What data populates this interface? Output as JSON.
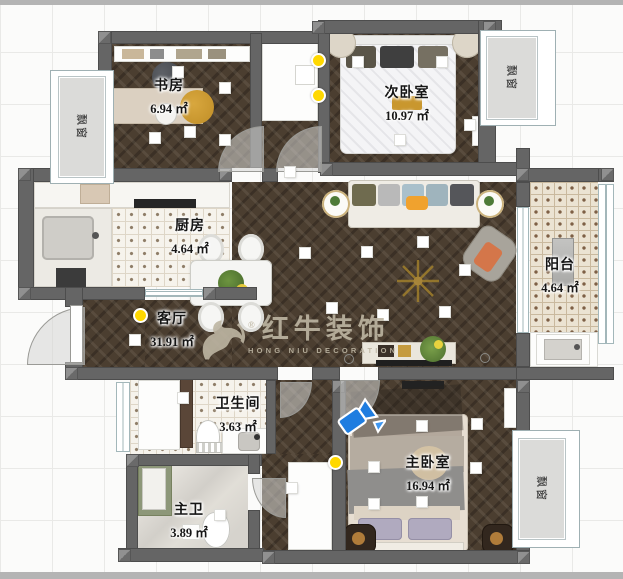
{
  "rooms": [
    {
      "name": "书房",
      "area": "6.94 ㎡"
    },
    {
      "name": "次卧室",
      "area": "10.97 ㎡"
    },
    {
      "name": "厨房",
      "area": "4.64 ㎡"
    },
    {
      "name": "客厅",
      "area": "31.91 ㎡"
    },
    {
      "name": "阳台",
      "area": "4.64 ㎡"
    },
    {
      "name": "卫生间",
      "area": "3.63 ㎡"
    },
    {
      "name": "主卫",
      "area": "3.89 ㎡"
    },
    {
      "name": "主卧室",
      "area": "16.94 ㎡"
    }
  ],
  "bay_windows": [
    {
      "label": "飘窗"
    },
    {
      "label": "飘窗"
    },
    {
      "label": "飘窗"
    }
  ],
  "watermark": {
    "registered": "®",
    "name_cn": "红牛装饰",
    "name_en": "HONG NIU DECORATION"
  },
  "colors": {
    "wall": "#656565",
    "wood_floor": "#4b3e30",
    "accent_gold": "#c9972e",
    "camera_blue": "#1f7de0",
    "light_yellow": "#ffd800"
  }
}
